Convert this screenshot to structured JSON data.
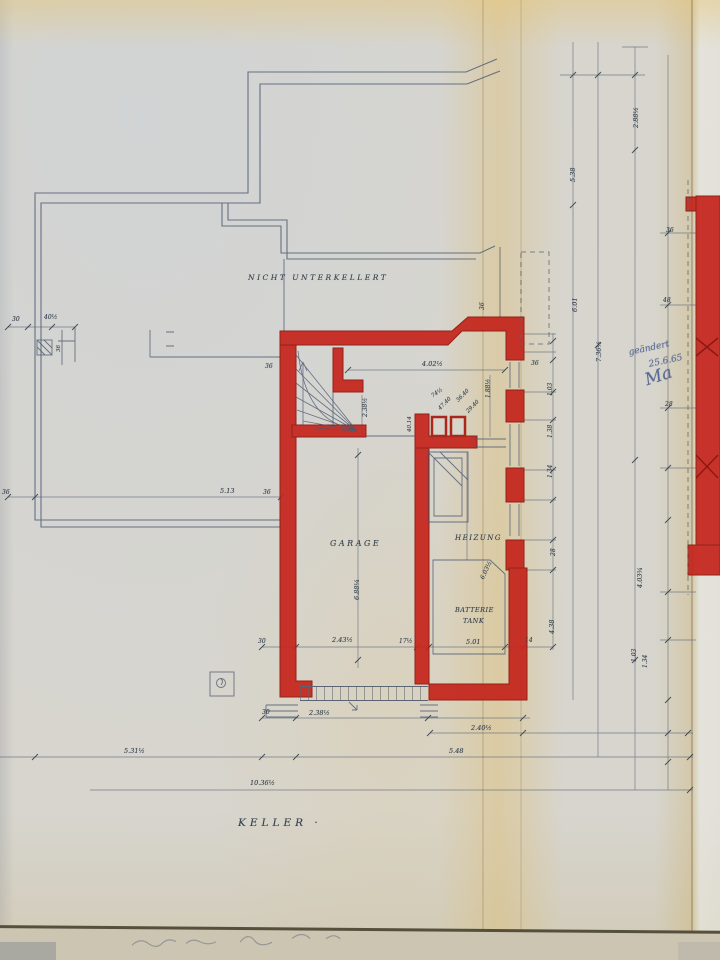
{
  "colors": {
    "wall_red": "#c5261d",
    "pencil_blue": "#4a5870",
    "paper": "#d7d5ce",
    "ink_blue": "#5a6b94"
  },
  "plan": {
    "area_label": "NICHT  UNTERKELLERT",
    "rooms": [
      "GARAGE",
      "HEIZUNG"
    ],
    "equipment": [
      "BATTERIE",
      "TANK"
    ],
    "drawing_title": "KELLER ·",
    "revision_note": {
      "line1": "geändert",
      "line2": "25.6.65",
      "signature": "Ma"
    }
  },
  "labels": [
    {
      "name": "area-label",
      "text": "NICHT  UNTERKELLERT",
      "x": 248,
      "y": 274,
      "fs": 7.5,
      "ls": 2.5
    },
    {
      "name": "room-label-garage",
      "text": "GARAGE",
      "x": 330,
      "y": 540,
      "fs": 8,
      "ls": 2.5
    },
    {
      "name": "room-label-heizung",
      "text": "HEIZUNG",
      "x": 455,
      "y": 535,
      "fs": 7,
      "ls": 1.5
    },
    {
      "name": "equipment-label-batterie",
      "text": "BATTERIE",
      "x": 455,
      "y": 607,
      "fs": 6.5,
      "ls": 0.5
    },
    {
      "name": "equipment-label-tank",
      "text": "TANK",
      "x": 463,
      "y": 618,
      "fs": 6.5,
      "ls": 0.5
    },
    {
      "name": "drawing-title",
      "text": "KELLER ·",
      "x": 238,
      "y": 818,
      "fs": 10.5,
      "ls": 4
    },
    {
      "name": "revision-note-word",
      "text": "geändert",
      "x": 628,
      "y": 349,
      "fs": 9,
      "rot": -12,
      "hw": true
    },
    {
      "name": "revision-note-date",
      "text": "25.6.65",
      "x": 648,
      "y": 361,
      "fs": 9,
      "rot": -12,
      "hw": true
    },
    {
      "name": "revision-signature",
      "text": "Ma",
      "x": 643,
      "y": 373,
      "fs": 17,
      "rot": -18,
      "hw": true
    },
    {
      "text": "30",
      "x": 12,
      "y": 317,
      "fs": 6
    },
    {
      "text": "40½",
      "x": 44,
      "y": 315,
      "fs": 6
    },
    {
      "text": "36",
      "x": 57,
      "y": 352,
      "fs": 5.5,
      "rot": -90
    },
    {
      "text": "36",
      "x": 2,
      "y": 490,
      "fs": 6
    },
    {
      "text": "5.13",
      "x": 220,
      "y": 488,
      "fs": 6.5
    },
    {
      "text": "36",
      "x": 263,
      "y": 490,
      "fs": 6
    },
    {
      "text": "36",
      "x": 265,
      "y": 364,
      "fs": 6
    },
    {
      "text": "4.02½",
      "x": 422,
      "y": 361,
      "fs": 6.5
    },
    {
      "text": "36",
      "x": 480,
      "y": 310,
      "fs": 6,
      "rot": -90
    },
    {
      "text": "1.88½",
      "x": 486,
      "y": 398,
      "fs": 6,
      "rot": -90
    },
    {
      "text": "2.38½",
      "x": 363,
      "y": 417,
      "fs": 6,
      "rot": -90
    },
    {
      "text": "74½",
      "x": 431,
      "y": 395,
      "fs": 5.5,
      "rot": -35
    },
    {
      "text": "47.40",
      "x": 438,
      "y": 408,
      "fs": 5.5,
      "rot": -45
    },
    {
      "text": "36.40",
      "x": 456,
      "y": 400,
      "fs": 5.5,
      "rot": -45
    },
    {
      "text": "29.40",
      "x": 466,
      "y": 411,
      "fs": 5.5,
      "rot": -45
    },
    {
      "text": "40.14",
      "x": 408,
      "y": 432,
      "fs": 5.5,
      "rot": -90
    },
    {
      "text": "6.88¼",
      "x": 354,
      "y": 600,
      "fs": 6.5,
      "rot": -90
    },
    {
      "text": "6.03½",
      "x": 480,
      "y": 578,
      "fs": 6,
      "rot": -65
    },
    {
      "text": "5.01",
      "x": 466,
      "y": 639,
      "fs": 6.5
    },
    {
      "text": "30",
      "x": 258,
      "y": 639,
      "fs": 6
    },
    {
      "text": "2.43½",
      "x": 332,
      "y": 637,
      "fs": 6.5
    },
    {
      "text": "17½",
      "x": 399,
      "y": 639,
      "fs": 6
    },
    {
      "text": "14",
      "x": 525,
      "y": 638,
      "fs": 6
    },
    {
      "text": "30",
      "x": 262,
      "y": 710,
      "fs": 6
    },
    {
      "text": "2.38½",
      "x": 309,
      "y": 710,
      "fs": 6.5
    },
    {
      "text": "2.40½",
      "x": 471,
      "y": 725,
      "fs": 6.5
    },
    {
      "text": "5.48",
      "x": 449,
      "y": 748,
      "fs": 6.5
    },
    {
      "text": "5.31½",
      "x": 124,
      "y": 748,
      "fs": 6.5
    },
    {
      "text": "10.36½",
      "x": 250,
      "y": 780,
      "fs": 6.5
    },
    {
      "text": "2.88½",
      "x": 633,
      "y": 128,
      "fs": 6.5,
      "rot": -90
    },
    {
      "text": "5.38",
      "x": 570,
      "y": 182,
      "fs": 6.5,
      "rot": -90
    },
    {
      "text": "6.01",
      "x": 572,
      "y": 312,
      "fs": 6.5,
      "rot": -90
    },
    {
      "text": "7.36½",
      "x": 596,
      "y": 362,
      "fs": 6.5,
      "rot": -90
    },
    {
      "text": "36",
      "x": 531,
      "y": 361,
      "fs": 6
    },
    {
      "text": "1.03",
      "x": 548,
      "y": 396,
      "fs": 6,
      "rot": -90
    },
    {
      "text": "1.38",
      "x": 548,
      "y": 438,
      "fs": 6,
      "rot": -90
    },
    {
      "text": "1.34",
      "x": 548,
      "y": 478,
      "fs": 6,
      "rot": -90
    },
    {
      "text": "28",
      "x": 551,
      "y": 556,
      "fs": 6,
      "rot": -90
    },
    {
      "text": "4.38",
      "x": 549,
      "y": 634,
      "fs": 6.5,
      "rot": -90
    },
    {
      "text": "4.03¾",
      "x": 637,
      "y": 588,
      "fs": 6.5,
      "rot": -90
    },
    {
      "text": "1.03",
      "x": 632,
      "y": 662,
      "fs": 6,
      "rot": -90
    },
    {
      "text": "1.34",
      "x": 643,
      "y": 668,
      "fs": 6,
      "rot": -90
    },
    {
      "text": "36",
      "x": 666,
      "y": 228,
      "fs": 6
    },
    {
      "text": "48",
      "x": 663,
      "y": 298,
      "fs": 6
    },
    {
      "text": "28",
      "x": 665,
      "y": 402,
      "fs": 6
    }
  ]
}
